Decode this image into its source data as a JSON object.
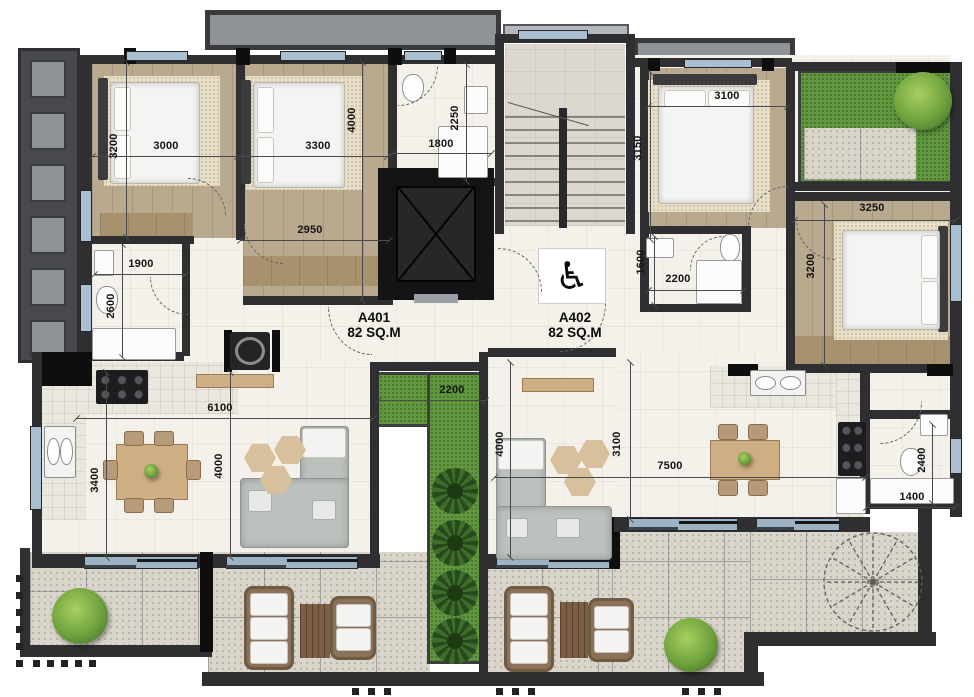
{
  "plan": {
    "apartments": [
      {
        "id": "A401",
        "area": "82 SQ.M"
      },
      {
        "id": "A402",
        "area": "82 SQ.M"
      }
    ],
    "icons": {
      "wheelchair": "♿"
    },
    "colors": {
      "wall": "#2f2f31",
      "wood_floor": "#b9a98f",
      "indoor_floor": "#f4f1ea",
      "terrace": "#d9d5ca",
      "grass": "#61973f",
      "window": "#aabfd0",
      "canopy": "#8f9398"
    },
    "dims": {
      "bedroom1_width": "3000",
      "bedroom1_depth": "3200",
      "bedroom2_width": "3300",
      "bedroom2_depth": "4000",
      "bath_top_width": "1800",
      "bath_top_depth": "2250",
      "hall_width": "2950",
      "wc_width": "1900",
      "wc_depth": "2600",
      "bedroom3_width": "3100",
      "bedroom3_depth": "3150",
      "bath_a402_depth": "1600",
      "bath_a402_width": "2200",
      "bedroom4_width": "3250",
      "bedroom4_depth": "3200",
      "living1_width": "6100",
      "living1_depth": "3400",
      "living1_span": "4000",
      "planter_width": "2200",
      "living2_span": "4000",
      "living2_depth": "3100",
      "living2_width": "7500",
      "bath3_depth": "2400",
      "bath3_width": "1400"
    }
  }
}
